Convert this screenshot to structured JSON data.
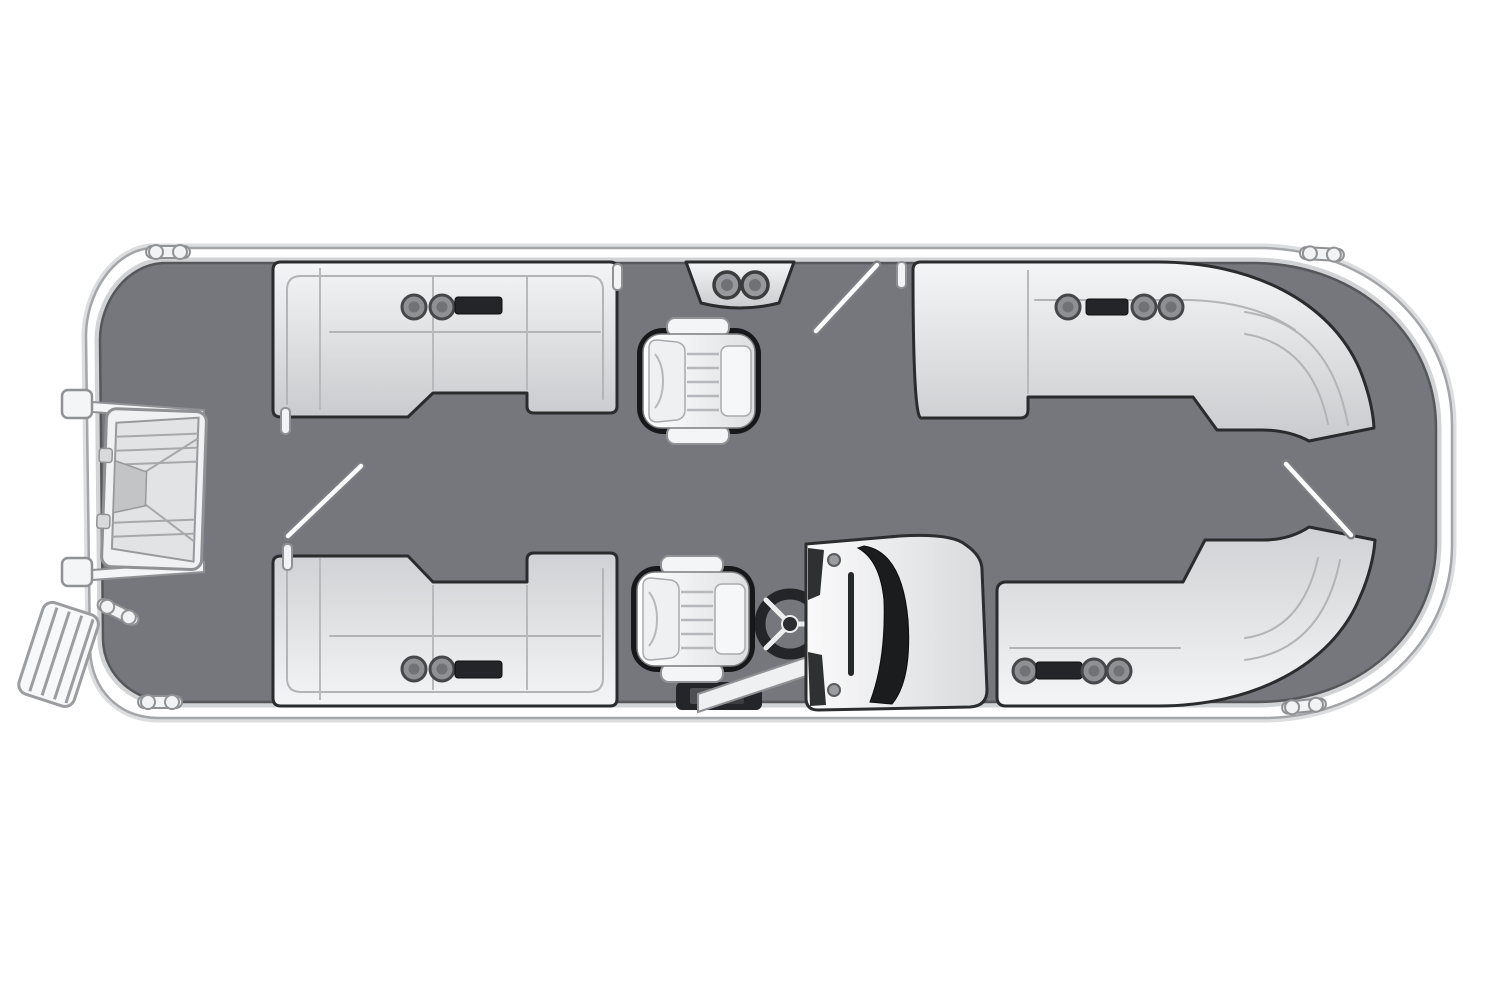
{
  "diagram": {
    "kind": "pontoon-boat-floorplan",
    "view": "top-down",
    "visible_text": "none",
    "orientation": {
      "bow": "right",
      "stern": "left",
      "port": "top",
      "starboard": "bottom"
    }
  },
  "colors": {
    "background": "#ffffff",
    "deck": "#75777c",
    "deck_outline": "#55575a",
    "hull": "#ffffff",
    "hull_outline": "#a3a5a8",
    "hull_halo": "#dcdddf",
    "hull_inner_band": "#d2d3d5",
    "seat_top": "#f4f5f6",
    "seat_bottom": "#c9cbce",
    "seat_outline": "#2a2b2d",
    "seam": "#b2b4b7",
    "chair_top": "#ffffff",
    "chair_bottom": "#dedfe1",
    "chair_outline": "#17181a",
    "pad": "#eff0f1",
    "tray": "#232528",
    "cupholder": "#8e9093",
    "cupholder_rim": "#45474a",
    "cupholder_inner": "#707275",
    "windshield": "#1b1c1e",
    "dark_trim": "#2e3032",
    "pedestal": "#232528",
    "rail": "#f2f3f4",
    "rail_outline": "#8f9194",
    "gate": "#fbfbfc",
    "gate_outline": "#7c7e81",
    "wheel_rim": "#232528",
    "wheel_spoke": "#eceded"
  },
  "components": [
    {
      "id": "hull",
      "label": "Pontoon hull with white rub rail"
    },
    {
      "id": "deck",
      "label": "Main deck (gray vinyl floor)"
    },
    {
      "id": "stern-steps",
      "label": "Stern walk-through steps",
      "position": "left"
    },
    {
      "id": "boarding-ladder",
      "label": "Stern boarding ladder",
      "position": "lower-left"
    },
    {
      "id": "aft-lounge-port",
      "label": "Port aft L-lounge with cupholders and tray",
      "position": "top-left"
    },
    {
      "id": "aft-lounge-starboard",
      "label": "Starboard aft L-lounge with cupholders and tray",
      "position": "bottom-left"
    },
    {
      "id": "bow-lounge-port",
      "label": "Port bow wraparound lounge",
      "position": "top-right"
    },
    {
      "id": "bow-lounge-starboard",
      "label": "Starboard bow wraparound lounge",
      "position": "bottom-right"
    },
    {
      "id": "companion-chair",
      "label": "Port companion captain's chair",
      "position": "center-top"
    },
    {
      "id": "helm-chair",
      "label": "Helm captain's chair",
      "position": "center-bottom"
    },
    {
      "id": "helm-console",
      "label": "Helm console with windshield",
      "position": "bottom-center-right"
    },
    {
      "id": "steering-wheel",
      "label": "Steering wheel",
      "position": "bottom-center"
    },
    {
      "id": "refreshment-console",
      "label": "Port console with two cupholders",
      "position": "top-center"
    },
    {
      "id": "stern-gate",
      "label": "Stern gate shown open",
      "position": "left-center"
    },
    {
      "id": "port-gate",
      "label": "Port side boarding gate shown open",
      "position": "top-center"
    },
    {
      "id": "bow-gate",
      "label": "Bow boarding gate shown open",
      "position": "right-center"
    },
    {
      "id": "cleats",
      "label": "Mooring cleats",
      "count": 5
    },
    {
      "id": "cupholders",
      "label": "Cupholders",
      "count": 12
    },
    {
      "id": "trays",
      "label": "Storage / device trays",
      "count": 4
    }
  ]
}
